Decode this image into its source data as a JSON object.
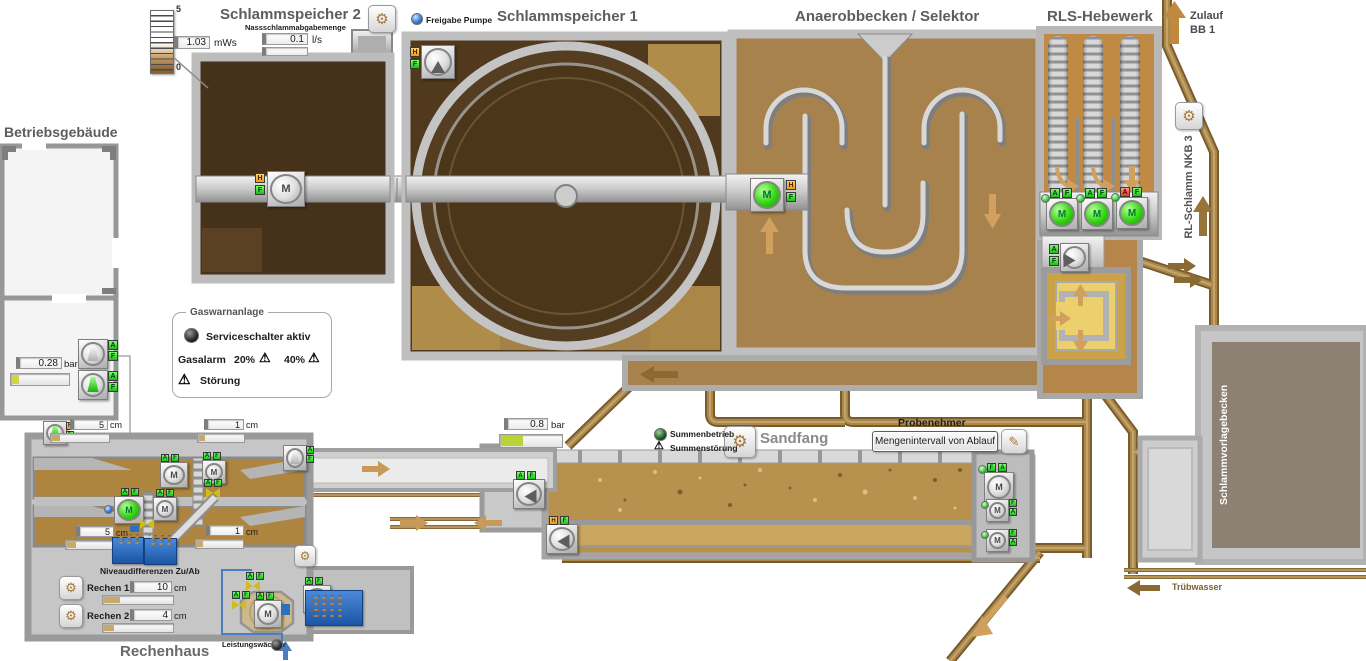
{
  "glyphs": {
    "A": "A",
    "F": "F",
    "H": "H",
    "M": "M",
    "warn": "⚠",
    "gear": "⚙",
    "pencil": "✎"
  },
  "units": {
    "cm": "cm",
    "mws": "mWs",
    "lps": "l/s",
    "bar": "bar"
  },
  "ss2": {
    "title": "Schlammspeicher 2",
    "level": "1.03",
    "scale_max": "5",
    "scale_min": "0",
    "abgabe_label": "Nassschlammabgabemenge",
    "abgabe_value": "0.1"
  },
  "ss1": {
    "title": "Schlammspeicher 1",
    "freigabe": "Freigabe Pumpe"
  },
  "anaerob": {
    "title": "Anaerobbecken / Selektor"
  },
  "rls": {
    "title": "RLS-Hebewerk",
    "zulauf1": "Zulauf",
    "zulauf2": "BB 1",
    "rl_schlamm": "RL-Schlamm NKB 3"
  },
  "gebaeude": {
    "title": "Betriebsgebäude",
    "druck": "0.28"
  },
  "gas": {
    "legend": "Gaswarnanlage",
    "service": "Serviceschalter aktiv",
    "alarm": "Gasalarm",
    "p20": "20%",
    "p40": "40%",
    "stoerung": "Störung"
  },
  "rh": {
    "title": "Rechenhaus",
    "zu_l": "5",
    "zu_r": "1",
    "ab_l": "5",
    "ab_r": "1",
    "niveau": "Niveaudifferenzen Zu/Ab",
    "r1": "Rechen 1",
    "r1v": "10",
    "r2": "Rechen 2",
    "r2v": "4",
    "leistung": "Leistungswächter"
  },
  "sf": {
    "title": "Sandfang",
    "druck": "0.8",
    "betrieb": "Summenbetrieb",
    "stoerung": "Summenstörung",
    "prob": "Probenehmer",
    "prob_btn": "Mengenintervall von Ablauf"
  },
  "svb": {
    "title": "Schlammvorlagebecken"
  },
  "tw": {
    "label": "Trübwasser"
  },
  "colors": {
    "status_green": "#35d613",
    "status_orange": "#f29a12",
    "pipe_brown": "#8a6a34",
    "tank_dark": "#4a351b",
    "tank_light": "#ae8549"
  }
}
